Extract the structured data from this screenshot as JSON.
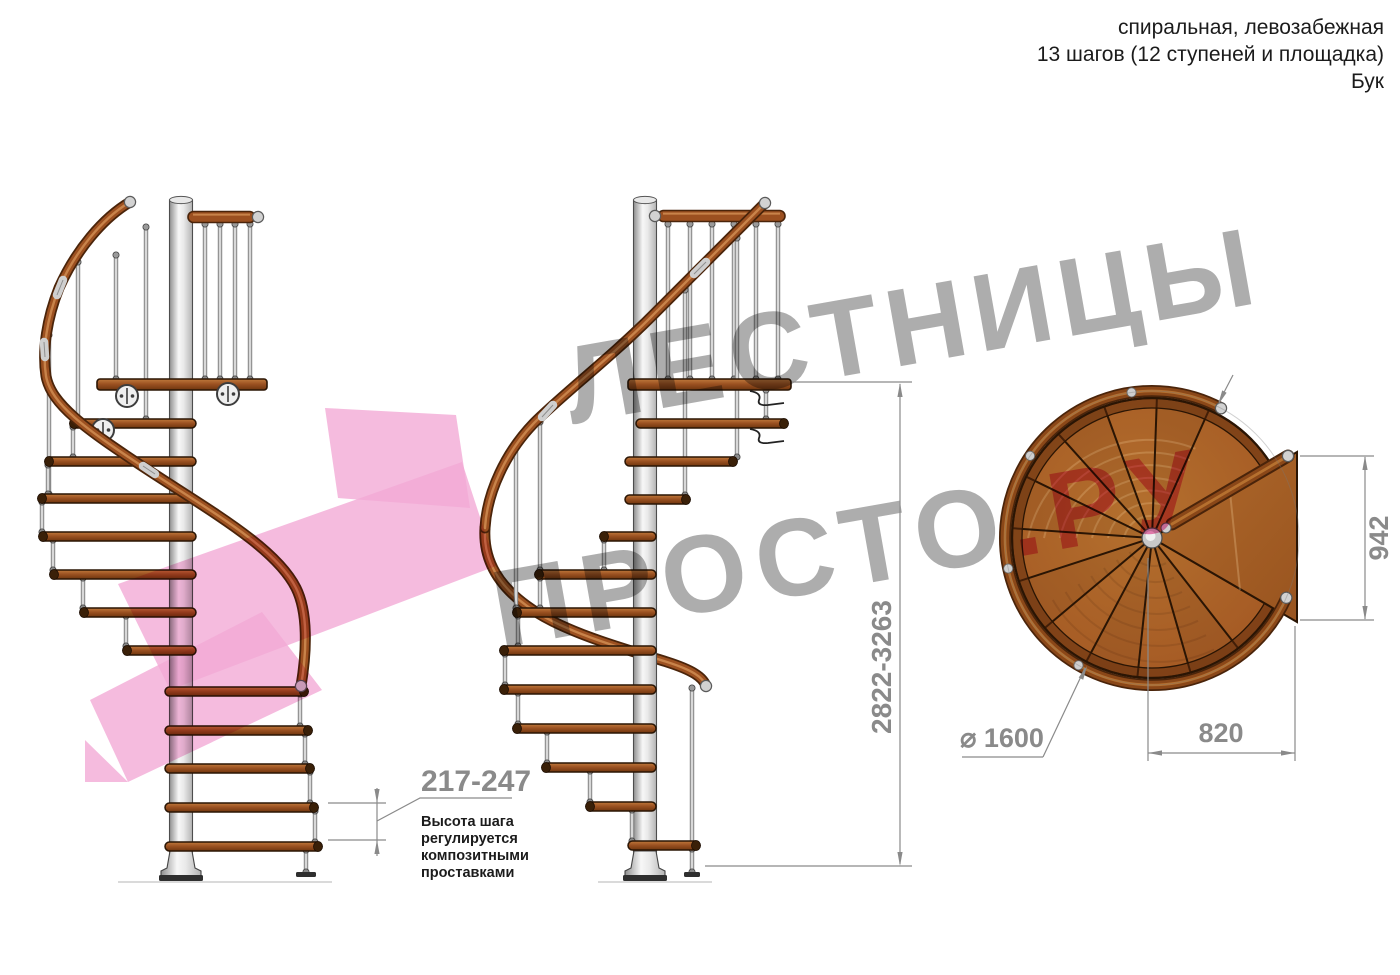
{
  "header": {
    "line1": "спиральная, левозабежная",
    "line2": "13 шагов (12 ступеней и площадка)",
    "line3": "Бук"
  },
  "dimensions": {
    "total_height": "2822-3263",
    "step_height": "217-247",
    "step_note_lines": [
      "Высота шага",
      "регулируется",
      "композитными",
      "проставками"
    ],
    "landing_height": "942",
    "landing_width": "820",
    "diameter": "⌀ 1600"
  },
  "watermark": {
    "word1": "ЛЕСТНИЦЫ",
    "word2": "ПРОСТО",
    "word3": ".РУ"
  },
  "colors": {
    "wood": "#a55a24",
    "wood_dark": "#6f350e",
    "outline": "#2a1504",
    "handrail": "#8a4718",
    "metal": "#d9d9d9",
    "watermark_gray": "#adadad",
    "watermark_pink": "#ee82b6",
    "arrow_pink": "#f3aad6",
    "dim_gray": "#8a8a8a",
    "text": "#1b1b1b"
  }
}
